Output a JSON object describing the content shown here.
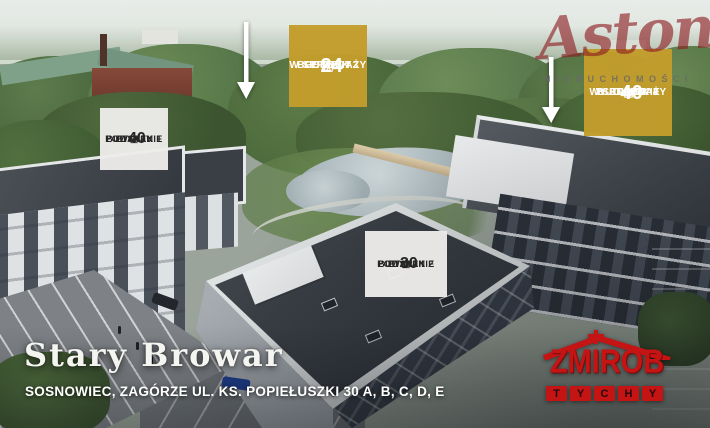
{
  "poster": {
    "project_title": "Stary Browar",
    "address": "SOSNOWIEC, ZAGÓRZE UL. KS. POPIEŁUSZKI 30 A, B, C, D, E"
  },
  "badges": {
    "etap1": {
      "stage": "ETAP I",
      "availability": "W SPRZEDAŻY",
      "units": "24",
      "building": "BUDYNEK 3",
      "status": "GOTOWY"
    },
    "etap2": {
      "stage": "ETAP II",
      "availability": "W SPRZEDAŻY",
      "units": "40",
      "building": "BUDYNEK 4",
      "status": "W BUDOWIE"
    },
    "etap3": {
      "stage": "ETAP III",
      "units": "30",
      "building": "BUDYNEK 2",
      "status": "POWSTANIE"
    },
    "etap4": {
      "stage": "ETAP IV",
      "units": "40",
      "building": "BUDYNEK 1",
      "status": "POWSTANIE"
    }
  },
  "watermark": {
    "brand": "Aston",
    "subtitle": "NIERUCHOMOŚCI"
  },
  "developer": {
    "name": "ZMIROB",
    "city": "TYCHY",
    "city_letters": [
      "T",
      "Y",
      "C",
      "H",
      "Y"
    ]
  },
  "colors": {
    "badge_gold": "#c29d2b",
    "badge_light": "#edecea",
    "logo_red": "#c41414",
    "watermark_red": "#8c1c20",
    "arrow_white": "#ffffff"
  }
}
